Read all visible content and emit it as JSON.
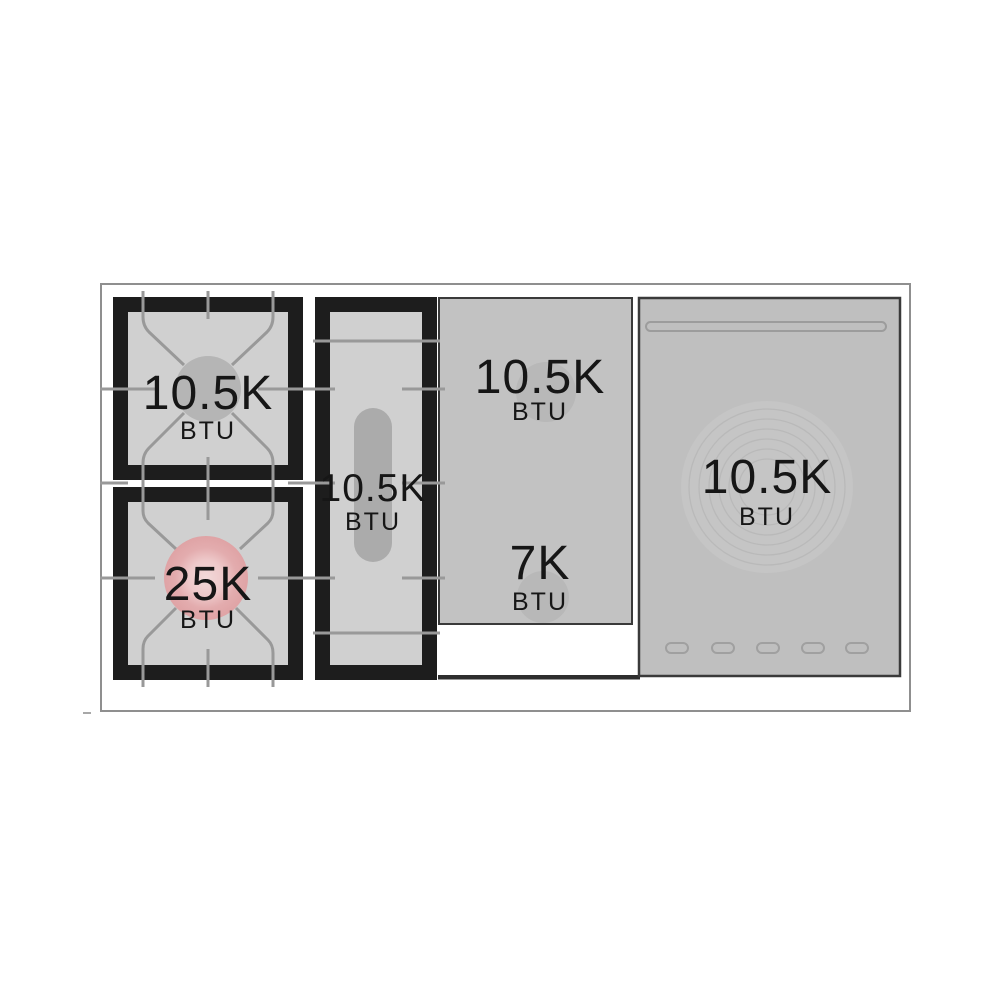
{
  "diagram": {
    "description": "Top view diagram of a range cooktop showing burner power ratings"
  },
  "burners": [
    {
      "id": "left-rear-burner",
      "power": "10.5K",
      "unit": "BTU"
    },
    {
      "id": "left-front-burner",
      "power": "25K",
      "unit": "BTU"
    },
    {
      "id": "center-griddle-burner",
      "power": "10.5K",
      "unit": "BTU"
    },
    {
      "id": "right-section-rear-burner",
      "power": "10.5K",
      "unit": "BTU"
    },
    {
      "id": "right-section-front-burner",
      "power": "7K",
      "unit": "BTU"
    },
    {
      "id": "far-right-round-plate",
      "power": "10.5K",
      "unit": "BTU"
    }
  ],
  "colors": {
    "frame_black": "#1d1d1d",
    "grate_surface_gray": "#d0d0d0",
    "panel_gray": "#c2c2c2",
    "right_panel_gray": "#bfbfbf",
    "burner_cap_gray": "#b5b5b5",
    "burner_cap_pink": "#e2a8aa",
    "grate_line_gray": "#999999",
    "outline_gray": "#8f8f8f",
    "text_color": "#161616"
  }
}
